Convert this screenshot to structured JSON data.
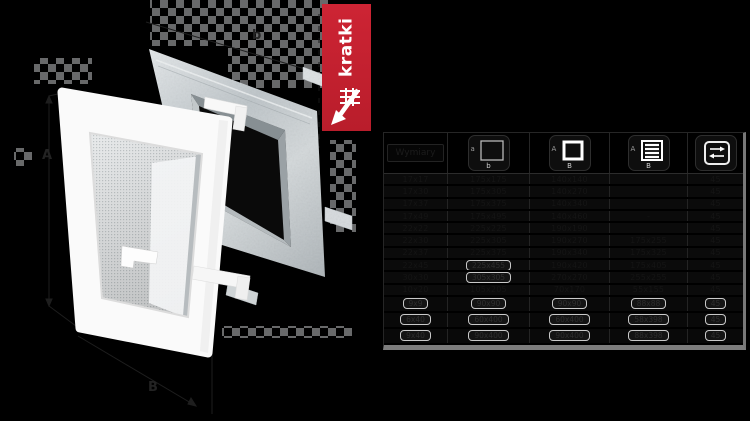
{
  "banner": {
    "brand": "kratki",
    "background": "#c4212f",
    "logo_icon": "kratki-grille-arrow-logo"
  },
  "illustration": {
    "description": "exploded view: white ventilation grille in front of galvanized steel mounting frame",
    "labels": {
      "left": "A",
      "top": "b",
      "bottom": "B"
    }
  },
  "table": {
    "corner_label": "Wymiary",
    "columns": [
      {
        "id": "size",
        "icon": ""
      },
      {
        "id": "outer-dimensions",
        "icon": "square-outline-icon",
        "side_label": "a",
        "bottom_label": "b"
      },
      {
        "id": "mounting-hole",
        "icon": "square-thick-outline-icon",
        "side_label": "A",
        "bottom_label": "B"
      },
      {
        "id": "louvered-front",
        "icon": "louvered-square-icon",
        "side_label": "A",
        "bottom_label": "B"
      },
      {
        "id": "depth",
        "icon": "double-arrow-icon"
      }
    ],
    "rows": [
      {
        "cells": [
          "17x17",
          "175x175",
          "140x140",
          "",
          "45"
        ],
        "boxed": [
          0,
          0,
          0,
          0,
          0
        ]
      },
      {
        "cells": [
          "17x30",
          "175x305",
          "140x270",
          "",
          "45"
        ],
        "boxed": [
          0,
          0,
          0,
          0,
          0
        ]
      },
      {
        "cells": [
          "17x37",
          "175x375",
          "140x340",
          "",
          "45"
        ],
        "boxed": [
          0,
          0,
          0,
          0,
          0
        ]
      },
      {
        "cells": [
          "17x49",
          "175x495",
          "140x460",
          "-",
          "45"
        ],
        "boxed": [
          0,
          0,
          0,
          0,
          0
        ]
      },
      {
        "cells": [
          "22x22",
          "225x225",
          "190x190",
          "",
          "45"
        ],
        "boxed": [
          0,
          0,
          0,
          0,
          0
        ]
      },
      {
        "cells": [
          "22x30",
          "225x305",
          "190x270",
          "175x255",
          "45"
        ],
        "boxed": [
          0,
          0,
          0,
          0,
          0
        ]
      },
      {
        "cells": [
          "22x37",
          "225x375",
          "190x340",
          "175x325",
          "45"
        ],
        "boxed": [
          0,
          0,
          0,
          0,
          0
        ]
      },
      {
        "cells": [
          "22x45",
          "225x455",
          "190x420",
          "175x405",
          "45"
        ],
        "boxed": [
          0,
          1,
          0,
          0,
          0
        ]
      },
      {
        "cells": [
          "30x30",
          "305x305",
          "270x270",
          "255x255",
          "45"
        ],
        "boxed": [
          0,
          1,
          0,
          0,
          0
        ]
      },
      {
        "cells": [
          "10x20",
          "105x205",
          "70x170",
          "55x155",
          "45"
        ],
        "boxed": [
          0,
          0,
          0,
          0,
          0
        ]
      },
      {
        "cells": [
          "9x9",
          "90x90",
          "90x90",
          "88x88",
          "45"
        ],
        "boxed": [
          1,
          1,
          1,
          1,
          1
        ]
      },
      {
        "cells": [
          "6x40",
          "60x400",
          "60x400",
          "58x398",
          "45"
        ],
        "boxed": [
          1,
          1,
          1,
          1,
          1
        ]
      },
      {
        "cells": [
          "9x40",
          "90x400",
          "90x400",
          "88x398",
          "45"
        ],
        "boxed": [
          1,
          1,
          1,
          1,
          1
        ]
      }
    ]
  },
  "colors": {
    "background": "#000000",
    "accent_red": "#c4212f",
    "metal": "#c3cacd",
    "grille_white": "#fafafa",
    "table_border": "#2a2a2a",
    "table_bottom_bar": "#7d7d7d",
    "row_text": "#151515"
  }
}
